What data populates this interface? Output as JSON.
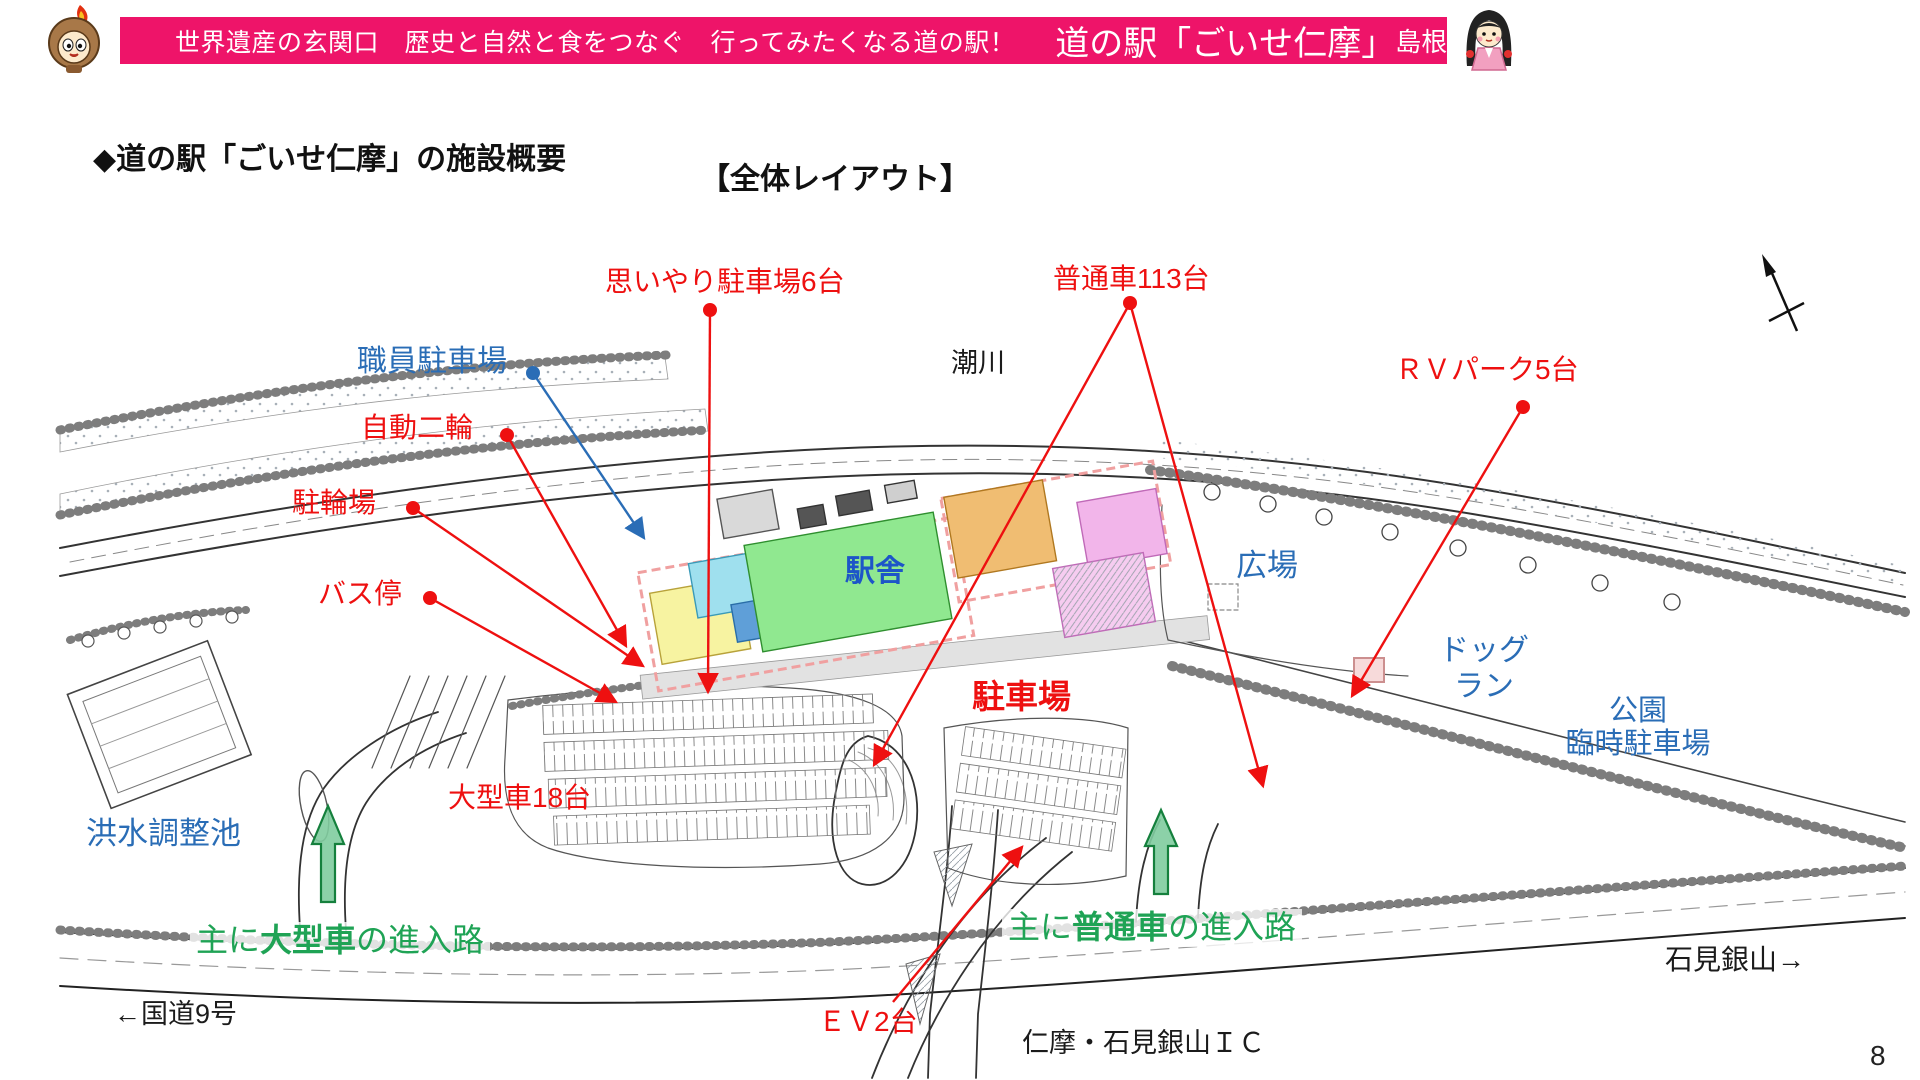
{
  "page_number": "8",
  "header": {
    "tagline": "世界遺産の玄関口　歴史と自然と食をつなぐ　行ってみたくなる道の駅！",
    "station_name": "道の駅「ごいせ仁摩」",
    "municipality": "島根県大田市"
  },
  "title": {
    "heading": "◆道の駅「ごいせ仁摩」の施設概要",
    "subtitle": "【全体レイアウト】"
  },
  "icons": {
    "mascot_left": "flame-hood-mascot",
    "mascot_right": "girl-kimono-mascot",
    "north_arrow": "north-arrow"
  },
  "map": {
    "labels": {
      "omoiyari": "思いやり駐車場6台",
      "futsusha": "普通車113台",
      "rv_park": "ＲＶパーク5台",
      "staff_parking": "職員駐車場",
      "jido_nirin": "自動二輪",
      "churinjo": "駐輪場",
      "bus_stop": "バス停",
      "ogata": "大型車18台",
      "parking": "駐車場",
      "ev": "ＥＶ2台",
      "station_building": "駅舎",
      "hiroba": "広場",
      "dog_run_1": "ドッグ",
      "dog_run_2": "ラン",
      "park_1": "公園",
      "park_2": "臨時駐車場",
      "flood_pond": "洪水調整池",
      "river": "潮川",
      "ic": "仁摩・石見銀山ＩＣ",
      "route9": "←国道9号",
      "iwami_ginzan": "石見銀山→",
      "entry_large_prefix": "主に",
      "entry_large_strong": "大型車",
      "entry_large_suffix": "の進入路",
      "entry_normal_prefix": "主に",
      "entry_normal_strong": "普通車",
      "entry_normal_suffix": "の進入路"
    },
    "colors": {
      "header_bg": "#ee1469",
      "label_red": "#ee1010",
      "label_blue": "#2a6db6",
      "label_green": "#1fa355",
      "station_label_blue": "#1d55c8",
      "arrow_green_fill": "#80cc9e",
      "arrow_green_stroke": "#15803d",
      "building_green": "#90e890",
      "building_yellow": "#f7f3a1",
      "building_cyan": "#9fe0ee",
      "building_blue": "#5f9fd8",
      "building_orange": "#f0bd72",
      "building_violet": "#f2b5ea",
      "building_outline_pink": "#f0a0a0"
    }
  }
}
